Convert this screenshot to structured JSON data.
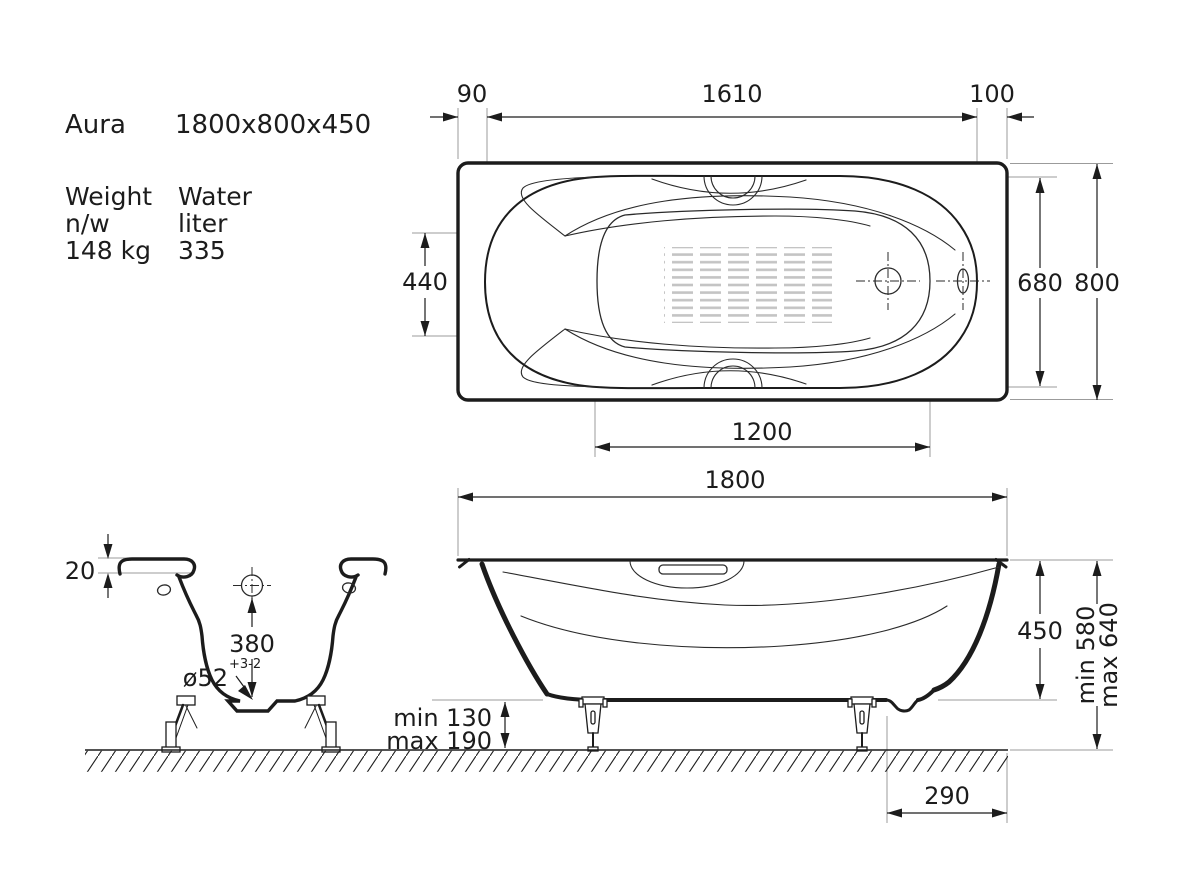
{
  "specs": {
    "name": "Aura",
    "size": "1800x800x450",
    "weight_label": "Weight",
    "weight_unit": "n/w",
    "weight_value": "148 kg",
    "water_label": "Water",
    "water_unit": "liter",
    "water_value": "335"
  },
  "plan": {
    "offset_left": "90",
    "rim_length": "1610",
    "offset_right": "100",
    "head_width": "440",
    "inner_width": "680",
    "outer_width": "800",
    "bottom_length": "1200"
  },
  "side": {
    "length": "1800",
    "height": "450",
    "install_min": "min 580",
    "install_max": "max 640",
    "feet_min": "min 130",
    "feet_max": "max 190",
    "drain_offset": "290"
  },
  "section": {
    "rim_thickness": "20",
    "drain_height": "380",
    "drain_diameter": "ø52",
    "drain_tolerance": "+3-2"
  },
  "colors": {
    "line": "#1c1c1c",
    "extension_line": "#9b9b9b",
    "antislip_gray": "#c4c4c4",
    "background": "#ffffff"
  }
}
